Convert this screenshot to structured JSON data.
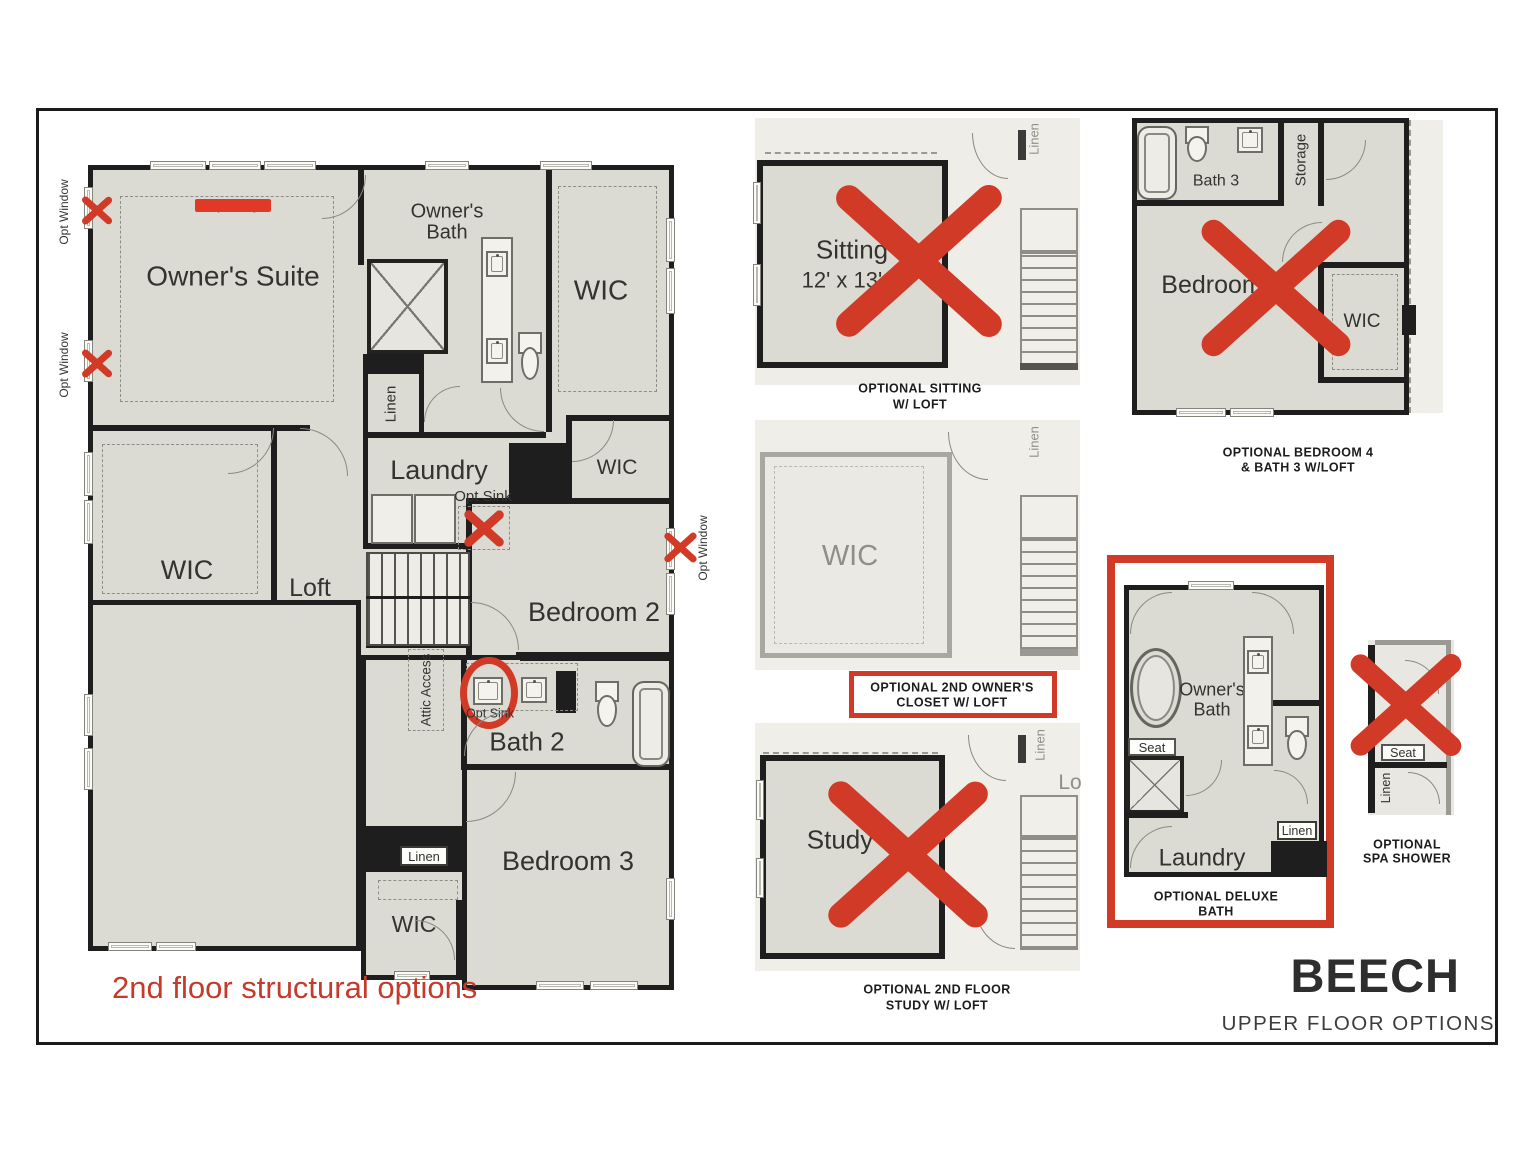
{
  "page": {
    "footnote": "2nd floor structural options",
    "title": "BEECH",
    "subtitle": "UPPER FLOOR OPTIONS"
  },
  "colors": {
    "annotation_red": "#d23a28",
    "footnote_red": "#c43b2b",
    "wall": "#1e1e1e",
    "room_fill": "#dcdbd3",
    "faded_fill": "#eeede7"
  },
  "main_plan": {
    "opt_window": "Opt Window",
    "opt_tray": "Opt Tray",
    "owners_suite": "Owner's Suite",
    "owners_bath_line1": "Owner's",
    "owners_bath_line2": "Bath",
    "wic_owner": "WIC",
    "linen_bath": "Linen",
    "laundry": "Laundry",
    "opt_sink_laundry": "Opt Sink",
    "wic_bedroom2": "WIC",
    "bedroom2": "Bedroom 2",
    "wic_lower": "WIC",
    "loft": "Loft",
    "attic_access": "Attic Access",
    "opt_sink_bath2": "Opt Sink",
    "bath2": "Bath 2",
    "linen_hall": "Linen",
    "bedroom3": "Bedroom 3",
    "wic_bedroom3": "WIC"
  },
  "options": {
    "sitting": {
      "room": "Sitting",
      "dims": "12' x 13'4",
      "linen": "Linen",
      "caption_line1": "OPTIONAL SITTING",
      "caption_line2": "W/ LOFT"
    },
    "bedroom4": {
      "bath3": "Bath 3",
      "storage": "Storage",
      "bedroom": "Bedroom",
      "wic": "WIC",
      "caption_line1": "OPTIONAL BEDROOM 4",
      "caption_line2": "& BATH 3 W/LOFT"
    },
    "wic_closet": {
      "room": "WIC",
      "linen": "Linen",
      "caption_line1": "OPTIONAL 2ND OWNER'S",
      "caption_line2": "CLOSET W/ LOFT"
    },
    "study": {
      "room": "Study",
      "loft_partial": "Lo",
      "linen": "Linen",
      "caption_line1": "OPTIONAL 2ND FLOOR",
      "caption_line2": "STUDY W/ LOFT"
    },
    "deluxe_bath": {
      "owners_bath_line1": "Owner's",
      "owners_bath_line2": "Bath",
      "seat": "Seat",
      "linen": "Linen",
      "laundry": "Laundry",
      "caption_line1": "OPTIONAL DELUXE",
      "caption_line2": "BATH"
    },
    "spa_shower": {
      "seat": "Seat",
      "linen": "Linen",
      "caption_line1": "OPTIONAL",
      "caption_line2": "SPA SHOWER"
    }
  }
}
